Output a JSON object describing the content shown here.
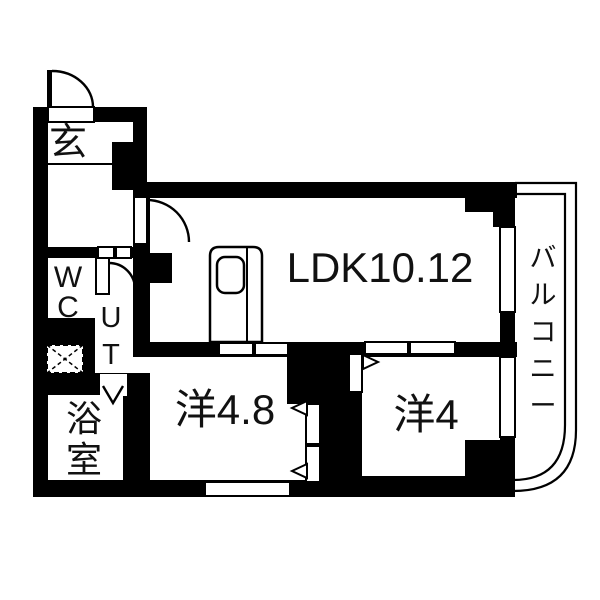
{
  "floorplan": {
    "rooms": {
      "entrance": {
        "label": "玄"
      },
      "wc": {
        "label": "WC"
      },
      "utility": {
        "label": "UT"
      },
      "bathroom": {
        "label": "浴室"
      },
      "ldk": {
        "label": "LDK10.12"
      },
      "western_room_large": {
        "label": "洋4.8"
      },
      "western_room_small": {
        "label": "洋4"
      },
      "balcony": {
        "label": "バルコニー"
      }
    },
    "colors": {
      "wall": "#000000",
      "floor": "#ffffff"
    }
  }
}
